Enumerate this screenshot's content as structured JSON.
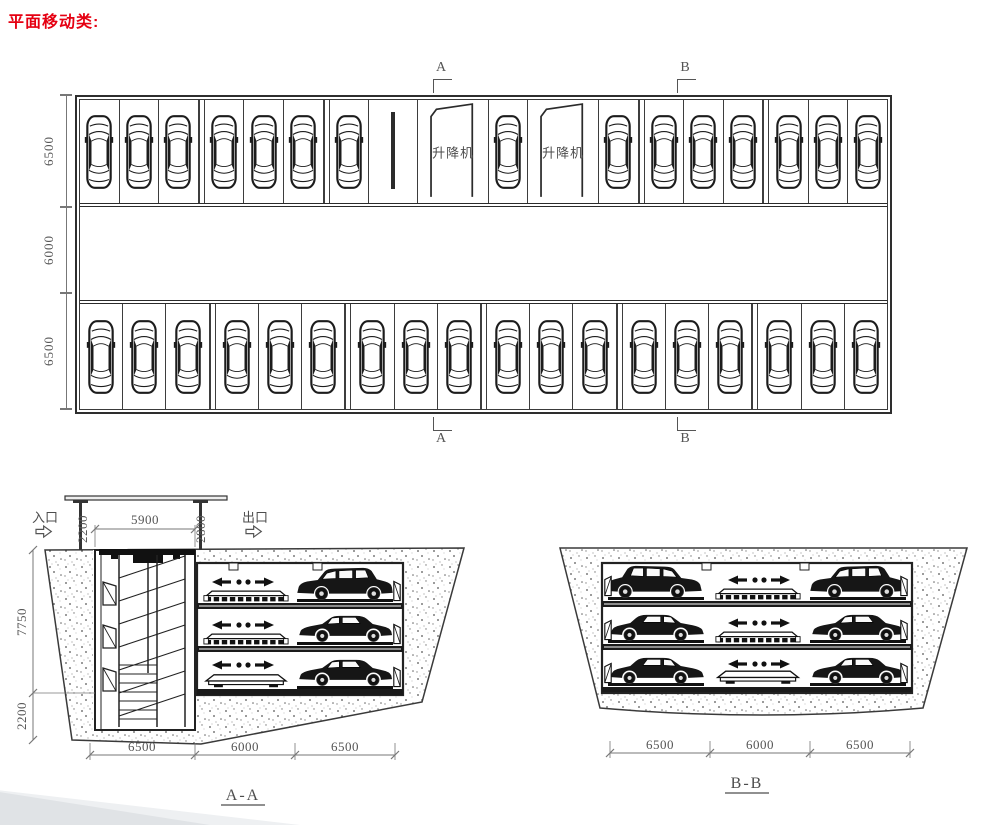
{
  "title": "平面移动类:",
  "colors": {
    "accent_red": "#e50012",
    "line": "#2b2b2b",
    "cad_text": "#555555"
  },
  "icons": {
    "entrance_arrow": "hollow-right-arrow",
    "exit_arrow": "hollow-right-arrow"
  },
  "plan": {
    "marker_a": "A",
    "marker_b": "B",
    "lift_label": "升降机",
    "dims_left": [
      "6500",
      "6000",
      "6500"
    ]
  },
  "section_aa": {
    "label": "A-A",
    "entrance_label": "入口",
    "exit_label": "出口",
    "dim_opening": "5900",
    "dim_left_clearance": "2200",
    "dim_right_clearance": "2800",
    "dim_depth_upper": "7750",
    "dim_depth_pit": "2200",
    "dims_bottom": [
      "6500",
      "6000",
      "6500"
    ]
  },
  "section_bb": {
    "label": "B-B",
    "dims_bottom": [
      "6500",
      "6000",
      "6500"
    ]
  }
}
